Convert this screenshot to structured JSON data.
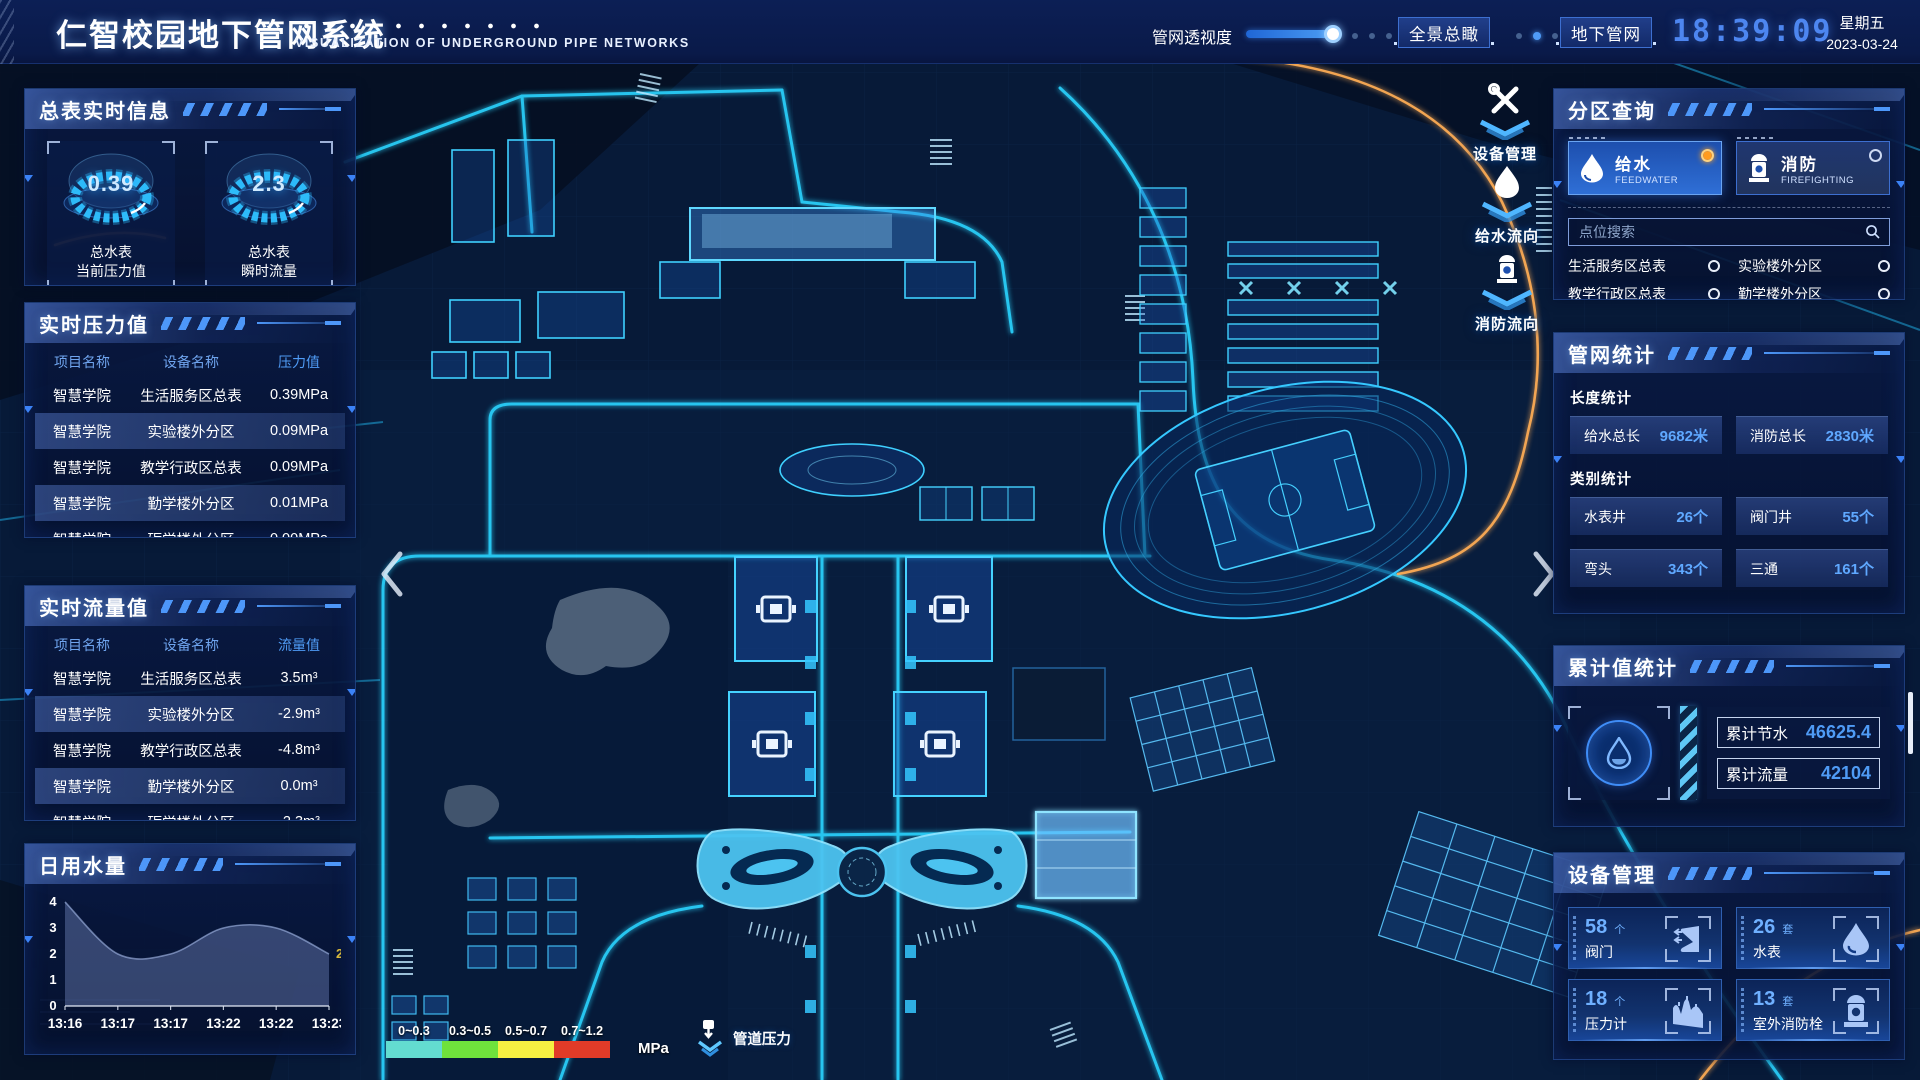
{
  "header": {
    "title": "仁智校园地下管网系统",
    "subtitle": "VISUALIZATION OF UNDERGROUND PIPE NETWORKS",
    "opacity_label": "管网透视度",
    "btn_overview": "全景总瞰",
    "btn_underground": "地下管网",
    "time": "18:39:09",
    "weekday": "星期五",
    "date": "2023-03-24"
  },
  "panels": {
    "meter_info": {
      "title": "总表实时信息",
      "gauges": [
        {
          "value": "0.39",
          "label1": "总水表",
          "label2": "当前压力值"
        },
        {
          "value": "2.3",
          "label1": "总水表",
          "label2": "瞬时流量"
        }
      ]
    },
    "pressure": {
      "title": "实时压力值",
      "headers": [
        "项目名称",
        "设备名称",
        "压力值"
      ],
      "rows": [
        [
          "智慧学院",
          "生活服务区总表",
          "0.39MPa"
        ],
        [
          "智慧学院",
          "实验楼外分区",
          "0.09MPa"
        ],
        [
          "智慧学院",
          "教学行政区总表",
          "0.09MPa"
        ],
        [
          "智慧学院",
          "勤学楼外分区",
          "0.01MPa"
        ],
        [
          "智慧学院",
          "砺学楼外分区",
          "0.00MPa"
        ]
      ]
    },
    "flow": {
      "title": "实时流量值",
      "headers": [
        "项目名称",
        "设备名称",
        "流量值"
      ],
      "rows": [
        [
          "智慧学院",
          "生活服务区总表",
          "3.5m³"
        ],
        [
          "智慧学院",
          "实验楼外分区",
          "-2.9m³"
        ],
        [
          "智慧学院",
          "教学行政区总表",
          "-4.8m³"
        ],
        [
          "智慧学院",
          "勤学楼外分区",
          "0.0m³"
        ],
        [
          "智慧学院",
          "砺学楼外分区",
          "-2.3m³"
        ]
      ]
    },
    "daily_water": {
      "title": "日用水量"
    },
    "zone_query": {
      "title": "分区查询",
      "tabs": [
        {
          "label": "给水",
          "sub": "FEEDWATER",
          "selected": true
        },
        {
          "label": "消防",
          "sub": "FIREFIGHTING",
          "selected": false
        }
      ],
      "search_placeholder": "点位搜索",
      "items": [
        "生活服务区总表",
        "实验楼外分区",
        "教学行政区总表",
        "勤学楼外分区",
        "砺学楼外分区",
        "宿舍区泵房"
      ]
    },
    "pipe_stats": {
      "title": "管网统计",
      "length_title": "长度统计",
      "length_stats": [
        {
          "label": "给水总长",
          "value": "9682米"
        },
        {
          "label": "消防总长",
          "value": "2830米"
        }
      ],
      "category_title": "类别统计",
      "category_stats": [
        {
          "label": "水表井",
          "value": "26个"
        },
        {
          "label": "阀门井",
          "value": "55个"
        },
        {
          "label": "弯头",
          "value": "343个"
        },
        {
          "label": "三通",
          "value": "161个"
        }
      ]
    },
    "cumulative": {
      "title": "累计值统计",
      "stats": [
        {
          "label": "累计节水",
          "value": "46625.4"
        },
        {
          "label": "累计流量",
          "value": "42104"
        }
      ]
    },
    "device_mgmt": {
      "title": "设备管理",
      "cards": [
        {
          "count": "58",
          "unit": "个",
          "label": "阀门",
          "icon": "valve"
        },
        {
          "count": "26",
          "unit": "套",
          "label": "水表",
          "icon": "water-meter"
        },
        {
          "count": "18",
          "unit": "个",
          "label": "压力计",
          "icon": "pressure-gauge"
        },
        {
          "count": "13",
          "unit": "套",
          "label": "室外消防栓",
          "icon": "hydrant"
        }
      ]
    }
  },
  "map": {
    "float_icons": [
      {
        "label": "设备管理",
        "icon": "tools"
      },
      {
        "label": "给水流向",
        "icon": "water-drop"
      },
      {
        "label": "消防流向",
        "icon": "hydrant"
      }
    ],
    "legend": {
      "ranges": [
        {
          "label": "0~0.3",
          "color": "#63dcd0"
        },
        {
          "label": "0.3~0.5",
          "color": "#6fe23c"
        },
        {
          "label": "0.5~0.7",
          "color": "#f5f042"
        },
        {
          "label": "0.7~1.2",
          "color": "#e13b28"
        }
      ],
      "unit": "MPa",
      "pressure_label": "管道压力"
    }
  },
  "chart_data": {
    "type": "area",
    "title": "日用水量",
    "x": [
      "13:16",
      "13:17",
      "13:17",
      "13:22",
      "13:22",
      "13:23"
    ],
    "values": [
      4,
      2,
      2,
      3,
      3,
      2
    ],
    "ylim": [
      0,
      4
    ],
    "yticks": [
      0,
      1,
      2,
      3,
      4
    ],
    "end_label": "2",
    "end_label_color": "#d8b93c",
    "xlabel": "",
    "ylabel": "",
    "legend_position": "none",
    "grid": false
  }
}
